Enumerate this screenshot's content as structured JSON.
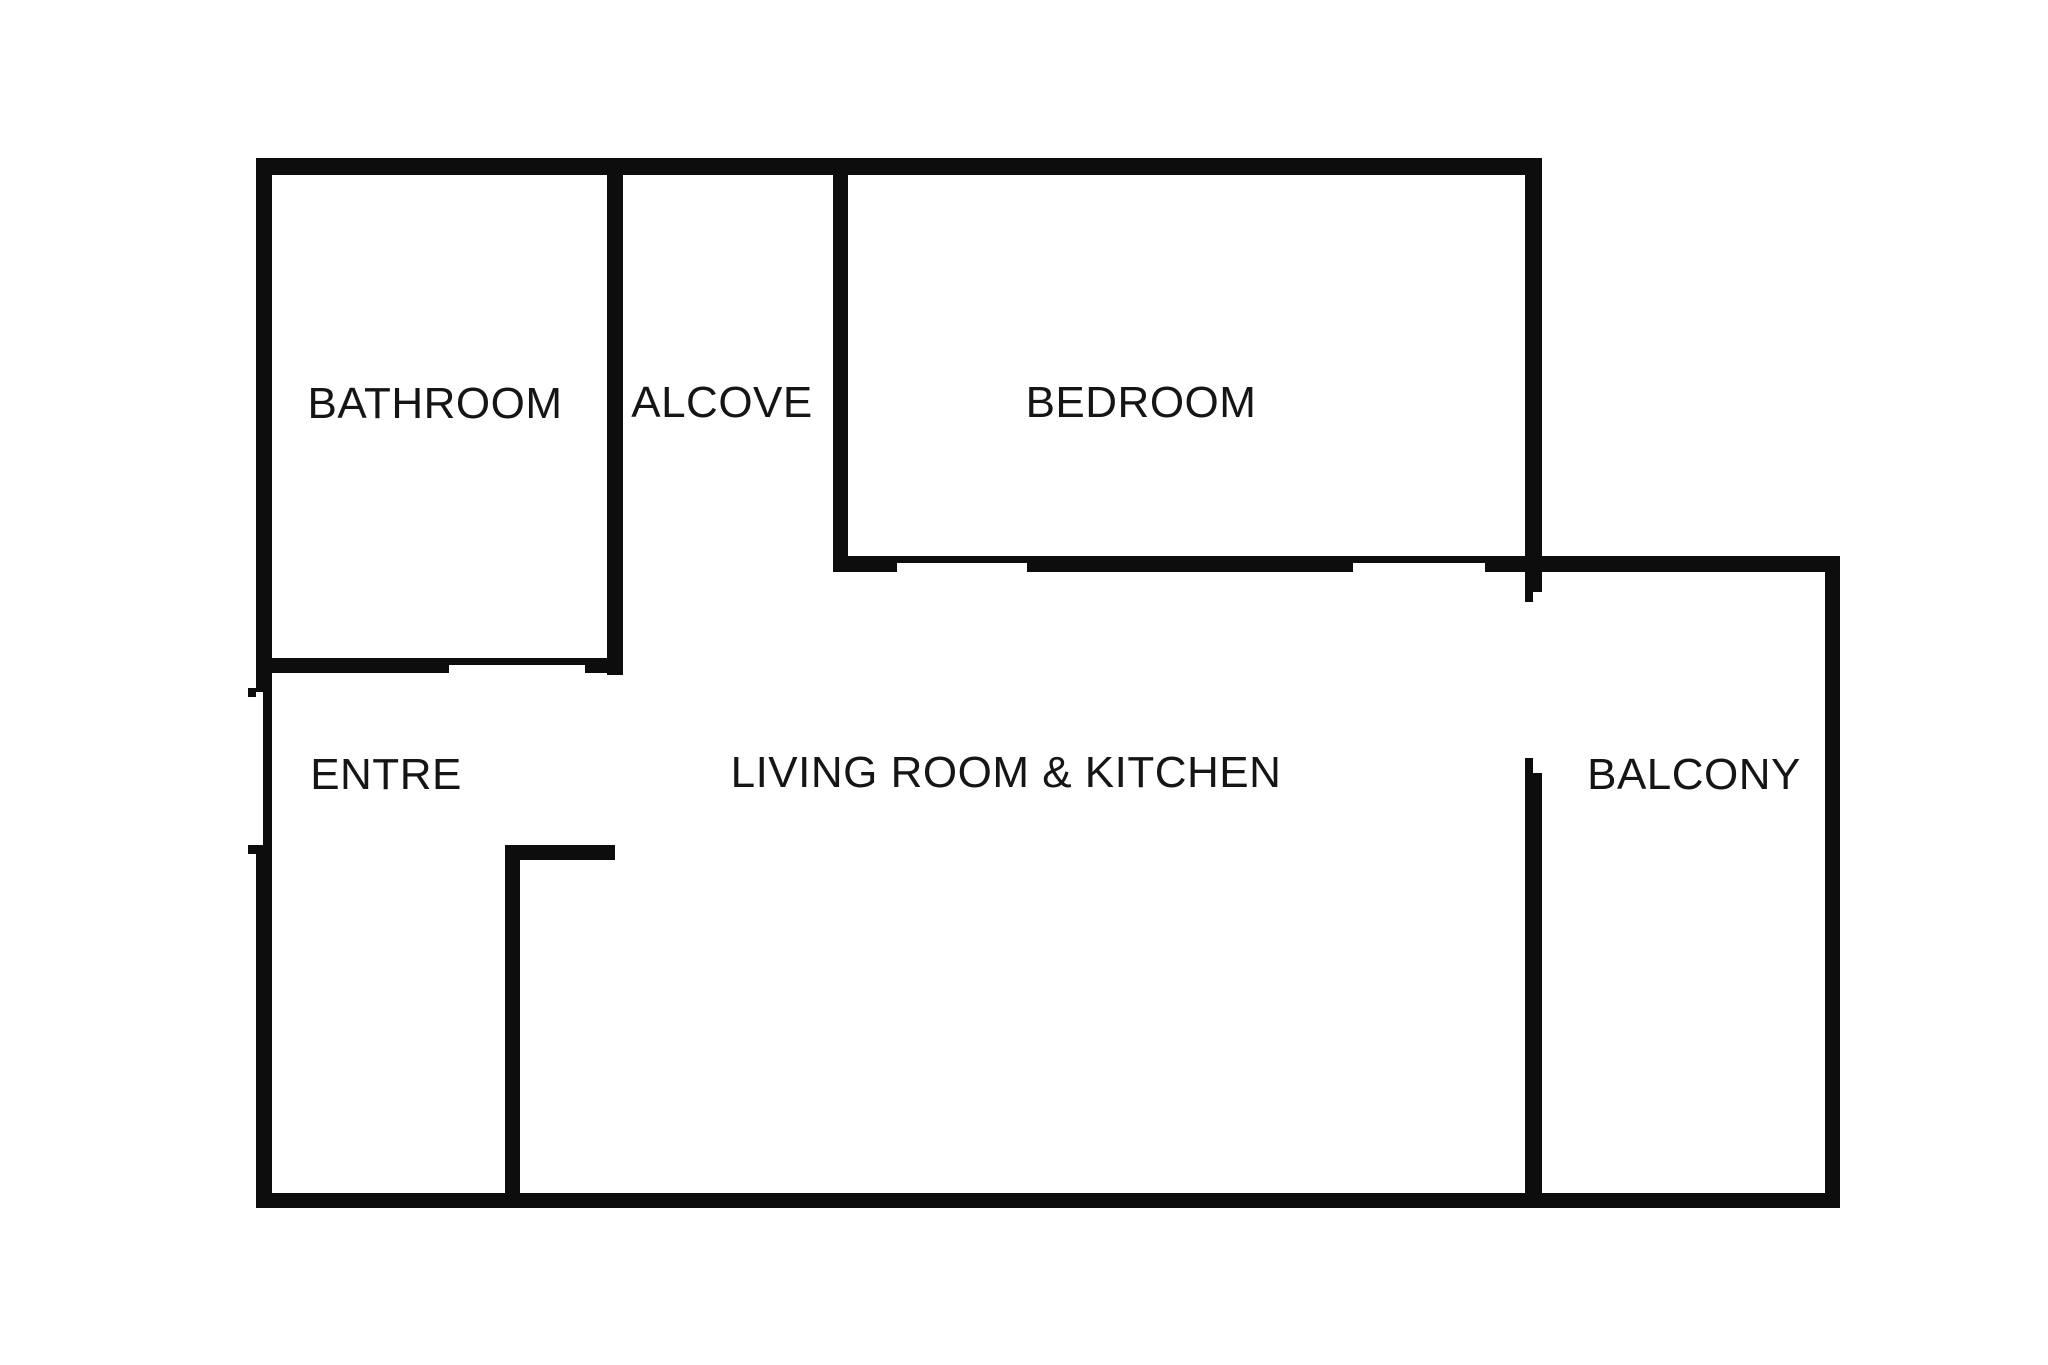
{
  "figure": {
    "type": "floor-plan",
    "background_color": "#ffffff",
    "wall_color": "#0d0d0d",
    "label_color": "#151515",
    "canvas": {
      "width": 2048,
      "height": 1365
    }
  },
  "rooms": [
    {
      "id": "bathroom",
      "label": "BATHROOM",
      "cx": 435,
      "cy": 404
    },
    {
      "id": "alcove",
      "label": "ALCOVE",
      "cx": 722,
      "cy": 403
    },
    {
      "id": "bedroom",
      "label": "BEDROOM",
      "cx": 1141,
      "cy": 403
    },
    {
      "id": "entre",
      "label": "ENTRE",
      "cx": 386,
      "cy": 775
    },
    {
      "id": "living-room-kitchen",
      "label": "LIVING ROOM & KITCHEN",
      "cx": 1006,
      "cy": 773
    },
    {
      "id": "balcony",
      "label": "BALCONY",
      "cx": 1694,
      "cy": 775
    }
  ],
  "walls": [
    {
      "id": "outer-top",
      "x": 256,
      "y": 158,
      "w": 1286,
      "h": 17
    },
    {
      "id": "outer-left-upper",
      "x": 256,
      "y": 158,
      "w": 16,
      "h": 534
    },
    {
      "id": "left-door-line",
      "x": 263,
      "y": 692,
      "w": 9,
      "h": 153
    },
    {
      "id": "left-door-jamb-upper",
      "x": 248,
      "y": 688,
      "w": 8,
      "h": 9
    },
    {
      "id": "left-door-jamb-lower",
      "x": 248,
      "y": 845,
      "w": 8,
      "h": 9
    },
    {
      "id": "outer-left-lower",
      "x": 256,
      "y": 845,
      "w": 16,
      "h": 363
    },
    {
      "id": "outer-bottom",
      "x": 256,
      "y": 1193,
      "w": 1584,
      "h": 15
    },
    {
      "id": "bathroom-alcove-wall",
      "x": 607,
      "y": 158,
      "w": 16,
      "h": 517
    },
    {
      "id": "bathroom-south-west",
      "x": 256,
      "y": 658,
      "w": 193,
      "h": 15
    },
    {
      "id": "bathroom-door-line",
      "x": 449,
      "y": 658,
      "w": 136,
      "h": 7
    },
    {
      "id": "bathroom-south-east",
      "x": 585,
      "y": 658,
      "w": 38,
      "h": 15
    },
    {
      "id": "alcove-bedroom-wall",
      "x": 833,
      "y": 158,
      "w": 15,
      "h": 414
    },
    {
      "id": "bedroom-south-a",
      "x": 833,
      "y": 556,
      "w": 64,
      "h": 16
    },
    {
      "id": "bedroom-door1-line",
      "x": 897,
      "y": 556,
      "w": 130,
      "h": 7
    },
    {
      "id": "bedroom-south-b",
      "x": 1027,
      "y": 556,
      "w": 326,
      "h": 16
    },
    {
      "id": "bedroom-door2-line",
      "x": 1353,
      "y": 556,
      "w": 132,
      "h": 7
    },
    {
      "id": "bedroom-south-c",
      "x": 1485,
      "y": 556,
      "w": 55,
      "h": 16
    },
    {
      "id": "right-wall-upper",
      "x": 1525,
      "y": 158,
      "w": 17,
      "h": 414
    },
    {
      "id": "balcony-door-jamb-top",
      "x": 1525,
      "y": 572,
      "w": 17,
      "h": 20
    },
    {
      "id": "balcony-door-line-top",
      "x": 1525,
      "y": 592,
      "w": 8,
      "h": 10
    },
    {
      "id": "balcony-door-line-bottom",
      "x": 1525,
      "y": 758,
      "w": 8,
      "h": 15
    },
    {
      "id": "right-wall-lower",
      "x": 1525,
      "y": 773,
      "w": 17,
      "h": 435
    },
    {
      "id": "balcony-top",
      "x": 1540,
      "y": 556,
      "w": 288,
      "h": 16
    },
    {
      "id": "balcony-right",
      "x": 1825,
      "y": 556,
      "w": 15,
      "h": 652
    },
    {
      "id": "entre-wall-vertical",
      "x": 505,
      "y": 845,
      "w": 15,
      "h": 350
    },
    {
      "id": "entre-wall-stub",
      "x": 505,
      "y": 845,
      "w": 110,
      "h": 15
    }
  ]
}
